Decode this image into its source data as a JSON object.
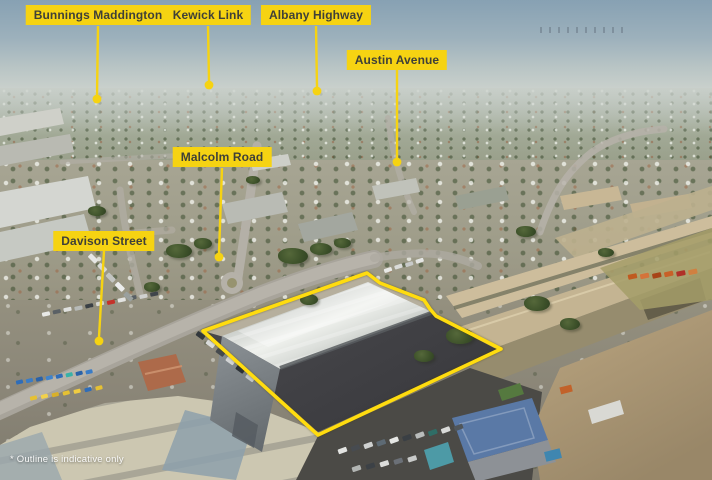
{
  "annotations": {
    "labels": [
      {
        "id": "bunnings-maddington",
        "text": "Bunnings Maddington"
      },
      {
        "id": "kewick-link",
        "text": "Kewick Link"
      },
      {
        "id": "albany-highway",
        "text": "Albany Highway"
      },
      {
        "id": "austin-avenue",
        "text": "Austin Avenue"
      },
      {
        "id": "malcolm-road",
        "text": "Malcolm Road"
      },
      {
        "id": "davison-street",
        "text": "Davison Street"
      }
    ],
    "disclaimer": "* Outline is indicative only"
  },
  "colors": {
    "label_background": "#F6D312",
    "label_text": "#3F4038",
    "pointer_line": "#F6D312",
    "property_outline": "#FFDC0F",
    "sky_top": "#87A1B3",
    "sky_horizon": "#CCD2CD"
  }
}
